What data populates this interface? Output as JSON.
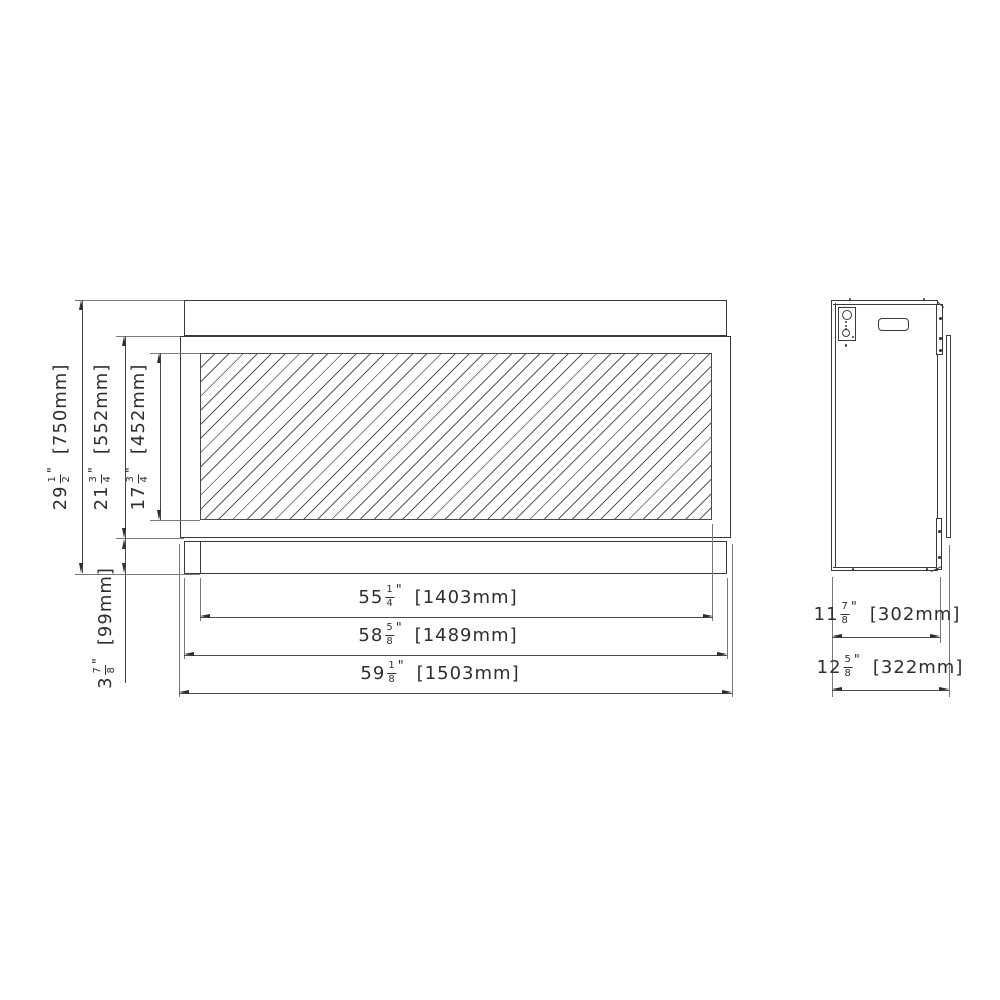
{
  "drawing": {
    "front_view": {
      "overall_height": {
        "whole": "29",
        "num": "1",
        "den": "2",
        "inch": "\"",
        "mm": "[750mm]"
      },
      "frame_height": {
        "whole": "21",
        "num": "3",
        "den": "4",
        "inch": "\"",
        "mm": "[552mm]"
      },
      "glass_height": {
        "whole": "17",
        "num": "3",
        "den": "4",
        "inch": "\"",
        "mm": "[452mm]"
      },
      "base_height": {
        "whole": "3",
        "num": "7",
        "den": "8",
        "inch": "\"",
        "mm": "[99mm]"
      },
      "opening_width": {
        "whole": "55",
        "num": "1",
        "den": "4",
        "inch": "\"",
        "mm": "[1403mm]"
      },
      "body_width": {
        "whole": "58",
        "num": "5",
        "den": "8",
        "inch": "\"",
        "mm": "[1489mm]"
      },
      "overall_width": {
        "whole": "59",
        "num": "1",
        "den": "8",
        "inch": "\"",
        "mm": "[1503mm]"
      }
    },
    "side_view": {
      "body_depth": {
        "whole": "11",
        "num": "7",
        "den": "8",
        "inch": "\"",
        "mm": "[302mm]"
      },
      "overall_depth": {
        "whole": "12",
        "num": "5",
        "den": "8",
        "inch": "\"",
        "mm": "[322mm]"
      }
    },
    "colors": {
      "object_line": "#3a3a3a",
      "dimension_line": "#2e2e2e",
      "background": "#ffffff"
    }
  }
}
